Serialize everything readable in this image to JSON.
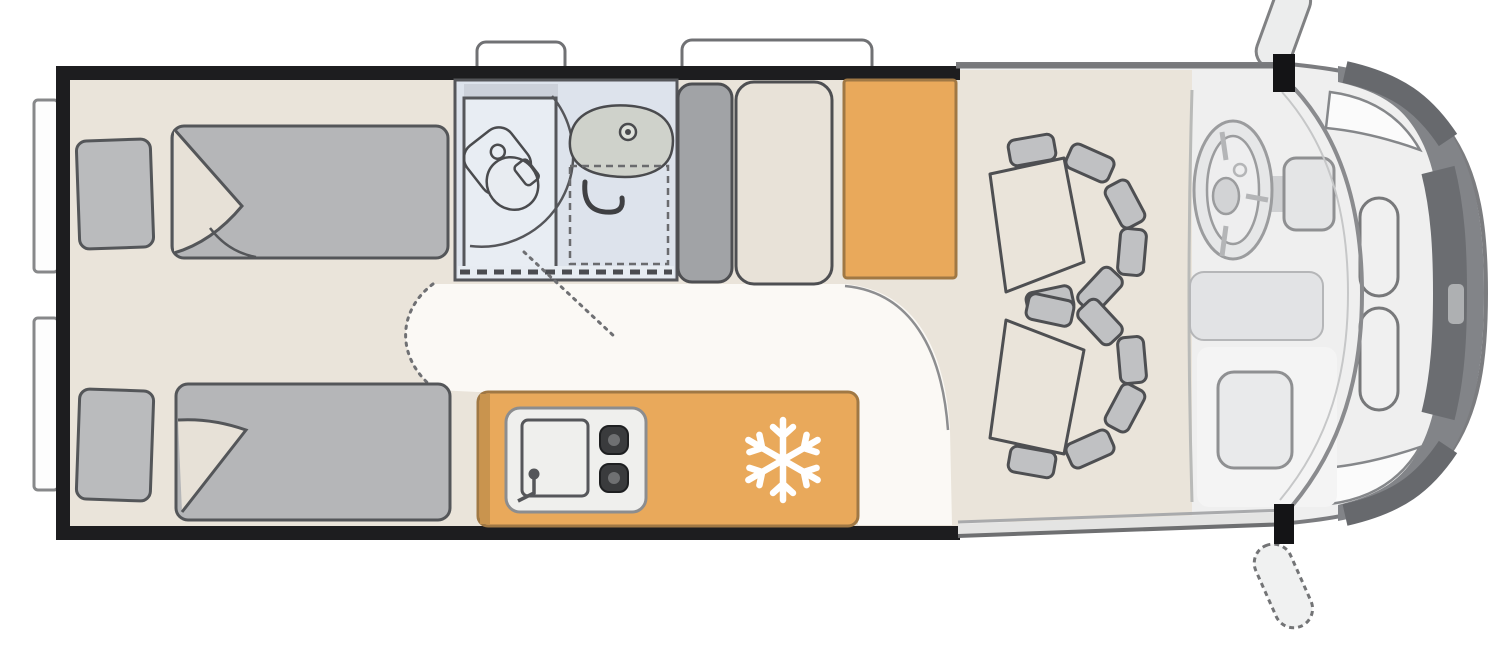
{
  "diagram": {
    "type": "floorplan",
    "subject": "Campervan / motorhome top-view floor plan",
    "orientation": "rear of vehicle at left, driver cab at right",
    "rooms": [
      {
        "name": "rear-bedroom",
        "description": "two single beds with pillows and folded duvets"
      },
      {
        "name": "bathroom",
        "description": "wet room with shower tray, swivel toilet and washbasin, sliding door"
      },
      {
        "name": "living-area",
        "description": "white aisle floor, wardrobe, bench seat, tall cabinet"
      },
      {
        "name": "kitchen",
        "description": "orange kitchen block with sink, two-burner hob and fridge (snowflake symbol)"
      },
      {
        "name": "cab",
        "description": "driver cab with steering wheel, dashboard and two swivel seats"
      }
    ],
    "fixtures": [
      "single-bed-left",
      "single-bed-right",
      "pillows",
      "shower-tray",
      "toilet",
      "washbasin",
      "bathroom-sliding-door",
      "wardrobe",
      "bench-seat",
      "tall-cabinet",
      "kitchen-counter",
      "kitchen-sink",
      "two-burner-hob",
      "fridge-snowflake-symbol",
      "swivel-seat-front-left",
      "swivel-seat-front-right",
      "steering-wheel",
      "dashboard-panels",
      "entry-step",
      "side-mirror-top",
      "side-mirror-bottom",
      "roof-window-small",
      "roof-window-large",
      "rear-door-windows",
      "headlights",
      "front-grille"
    ]
  },
  "colors": {
    "wall": "#1d1d1f",
    "floor": "#eae4da",
    "aisle": "#fbf9f5",
    "bathroom_floor": "#dde3ec",
    "shower": "#e8edf3",
    "furniture_gray": "#b5b6b8",
    "pillow_gray": "#babbbd",
    "wardrobe_gray": "#a1a3a6",
    "bench_beige": "#e8e2d8",
    "cabinet_orange": "#e9a95b",
    "orange_border": "#a07844",
    "cab_body": "#efefef",
    "cab_floor": "#eae4da",
    "front_band": "#828488",
    "seat_block_gray": "#c0c1c3",
    "cushion_beige": "#eae4da",
    "stove_panel": "#efefed",
    "burner_dark": "#3a3b3d",
    "snowflake": "#ffffff",
    "window_white": "#ffffff",
    "basin_gray": "#cfd2cb",
    "step_gray": "#e4e4e3"
  }
}
